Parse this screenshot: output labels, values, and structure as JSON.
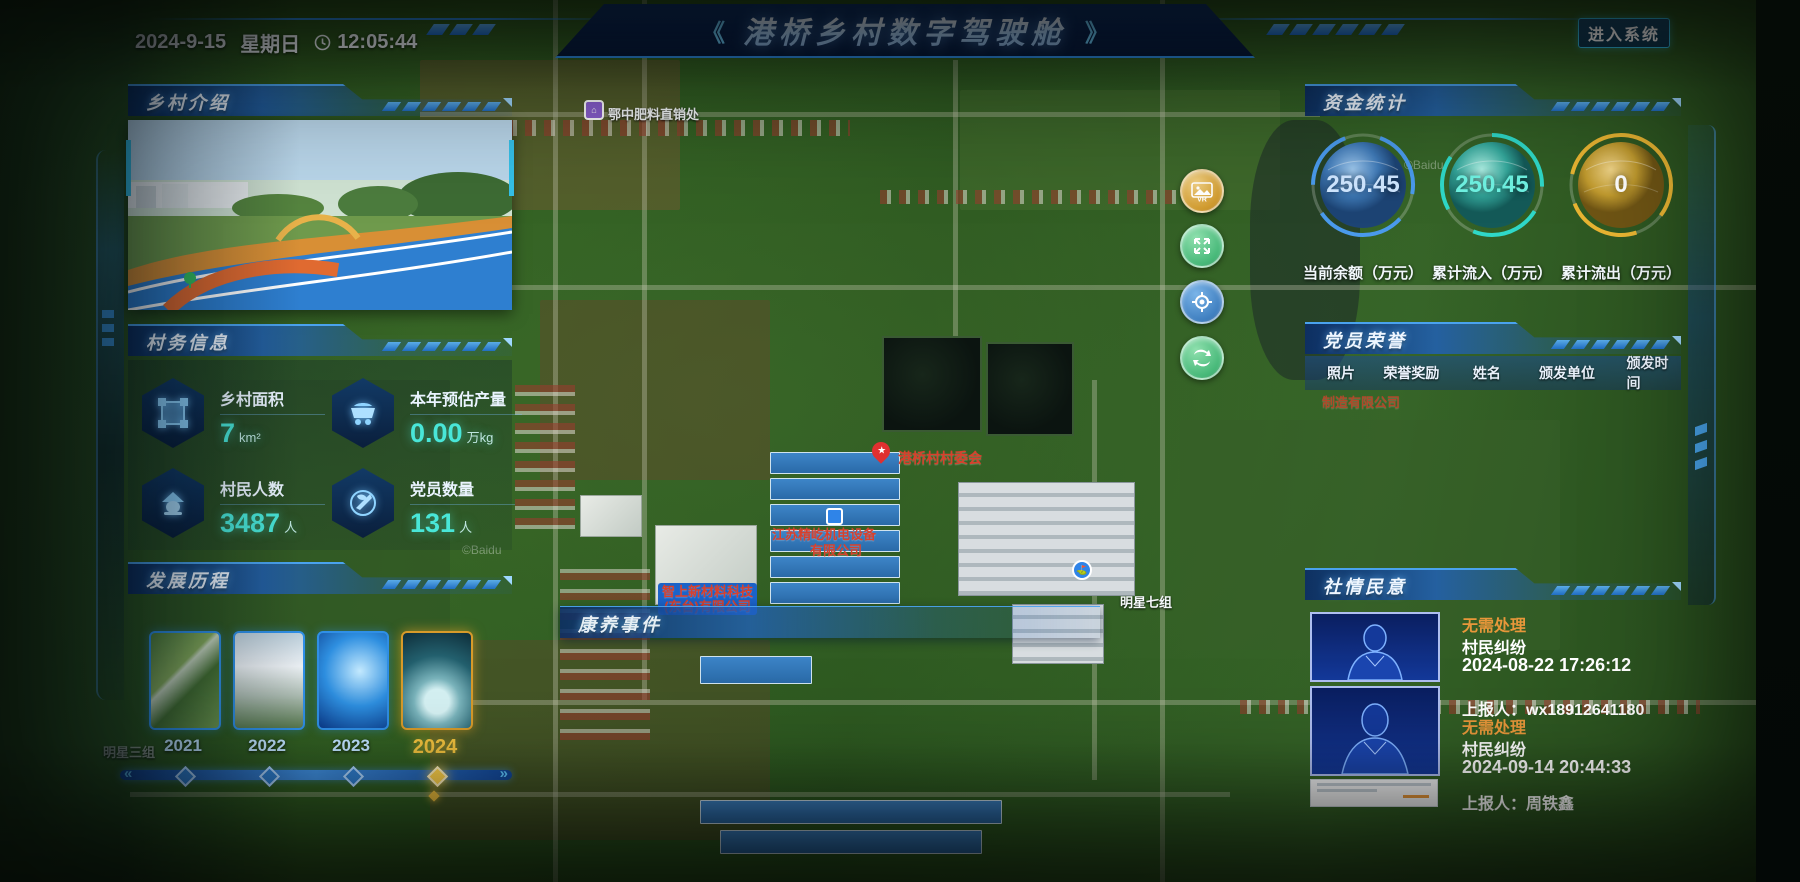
{
  "header": {
    "date": "2024-9-15",
    "weekday": "星期日",
    "time": "12:05:44",
    "title": "港桥乡村数字驾驶舱",
    "arrow_left": "《",
    "arrow_right": "》",
    "enter_button": "进入系统"
  },
  "village_intro": {
    "title": "乡村介绍"
  },
  "village_affairs": {
    "title": "村务信息",
    "stats": [
      {
        "icon": "area-icon",
        "label": "乡村面积",
        "value": "7",
        "unit": "km²"
      },
      {
        "icon": "cart-icon",
        "label": "本年预估产量",
        "value": "0.00",
        "unit": "万kg"
      },
      {
        "icon": "villager-icon",
        "label": "村民人数",
        "value": "3487",
        "unit": "人"
      },
      {
        "icon": "party-icon",
        "label": "党员数量",
        "value": "131",
        "unit": "人"
      }
    ]
  },
  "development": {
    "title": "发展历程",
    "years": [
      {
        "label": "2021",
        "selected": false
      },
      {
        "label": "2022",
        "selected": false
      },
      {
        "label": "2023",
        "selected": false
      },
      {
        "label": "2024",
        "selected": true
      }
    ]
  },
  "funds": {
    "title": "资金统计",
    "gauges": [
      {
        "value": "250.45",
        "label": "当前余额（万元）",
        "color": "#4a9aec"
      },
      {
        "value": "250.45",
        "label": "累计流入（万元）",
        "color": "#2fd8c8"
      },
      {
        "value": "0",
        "label": "累计流出（万元）",
        "color": "#e8b432"
      }
    ]
  },
  "party_honor": {
    "title": "党员荣誉",
    "columns": [
      "照片",
      "荣誉奖励",
      "姓名",
      "颁发单位",
      "颁发时间"
    ]
  },
  "public_opinion": {
    "title": "社情民意",
    "items": [
      {
        "status": "无需处理",
        "category": "村民纠纷",
        "time": "2024-08-22 17:26:12",
        "reporter": "上报人：wx18912641180"
      },
      {
        "status": "无需处理",
        "category": "村民纠纷",
        "time": "2024-09-14 20:44:33",
        "reporter": "上报人：周铁鑫"
      }
    ]
  },
  "health_events": {
    "title": "康养事件"
  },
  "map": {
    "labels": {
      "fertilizer": "鄂中肥料直销处",
      "committee": "港桥村村委会",
      "company1_line1": "江苏精屹机电设备",
      "company1_line2": "有限公司",
      "company2_line1": "智上新材料科技",
      "company2_line2": "(东台)有限公司",
      "company3_partial": "制造有限公司",
      "group7": "明星七组",
      "group3": "明星三组",
      "watermark": "©Baidu"
    },
    "controls": {
      "vr": "VR",
      "fullscreen": "fullscreen",
      "locate": "locate",
      "switch": "switch"
    },
    "accent_colors": {
      "panel_blue": "#2f8fe6",
      "value_cyan": "#49e6d8",
      "selected_year_gold": "#f2c23e",
      "status_orange": "#e8973a"
    }
  }
}
